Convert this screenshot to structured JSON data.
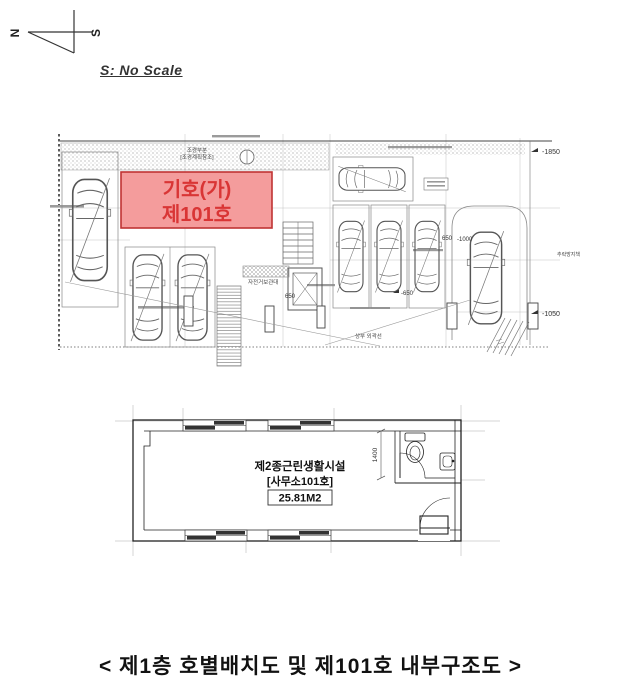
{
  "compass": {
    "north": "N",
    "south": "S"
  },
  "scale_note": "S: No Scale",
  "site_plan": {
    "unit_box": {
      "line1": "기호(가)",
      "line2": "제101호",
      "fill": "#f49c9c",
      "stroke": "#c03333",
      "text_color": "#d93535"
    },
    "labels": {
      "landscape_1": "조경부분",
      "landscape_2": "[조경계획참조]",
      "elev_top_right": "-1850",
      "elev_bottom_right": "-1050",
      "fall_guard": "추락방지책",
      "bike_rack": "자전거보관대",
      "dim_650": "650",
      "dim_neg650": "-650",
      "dim_neg1000": "-1000",
      "upper_outline": "상부 외곽선"
    }
  },
  "floor_plan": {
    "room_type": "제2종근린생활시설",
    "room_no": "[사무소101호]",
    "area": "25.81M2",
    "dim_1400": "1400"
  },
  "caption": "< 제1층 호별배치도 및 제101호 내부구조도 >"
}
